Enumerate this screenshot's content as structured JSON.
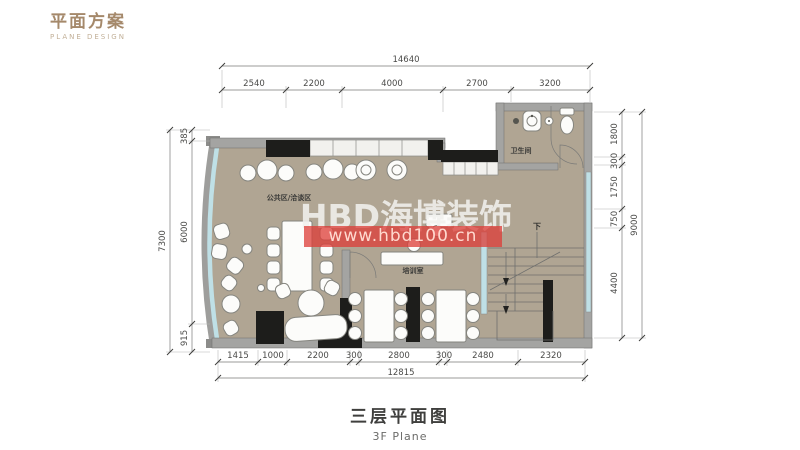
{
  "logo": {
    "title": "平面方案",
    "subtitle": "PLANE DESIGN"
  },
  "caption": {
    "title": "三层平面图",
    "subtitle": "3F Plane"
  },
  "watermark": {
    "brand": "HBD海博装饰",
    "url": "www.hbd100.cn",
    "bar_color": "#dd3e39"
  },
  "plan": {
    "rooms": {
      "public": "公共区/洽谈区",
      "training": "培训室",
      "bathroom": "卫生间"
    },
    "stair_direction": "下"
  },
  "dimensions": {
    "top": {
      "total": "14640",
      "segments": [
        "2540",
        "2200",
        "4000",
        "2700",
        "3200"
      ]
    },
    "bottom": {
      "total": "12815",
      "segments": [
        "1415",
        "1000",
        "2200",
        "300",
        "2800",
        "300",
        "2480",
        "2320"
      ]
    },
    "left": {
      "total": "7300",
      "segments": [
        "385",
        "6000",
        "915"
      ]
    },
    "right": {
      "total": "9000",
      "segments": [
        "1800",
        "300",
        "1750",
        "750",
        "4400"
      ]
    }
  },
  "colors": {
    "accent_brown": "#a5896b",
    "watermark_red": "#dd3e39",
    "floor_tan": "#b0a593",
    "glazing_blue": "#bfe0e6",
    "wall_gray": "#a4a4a2",
    "wall_black": "#1d1d1b"
  }
}
